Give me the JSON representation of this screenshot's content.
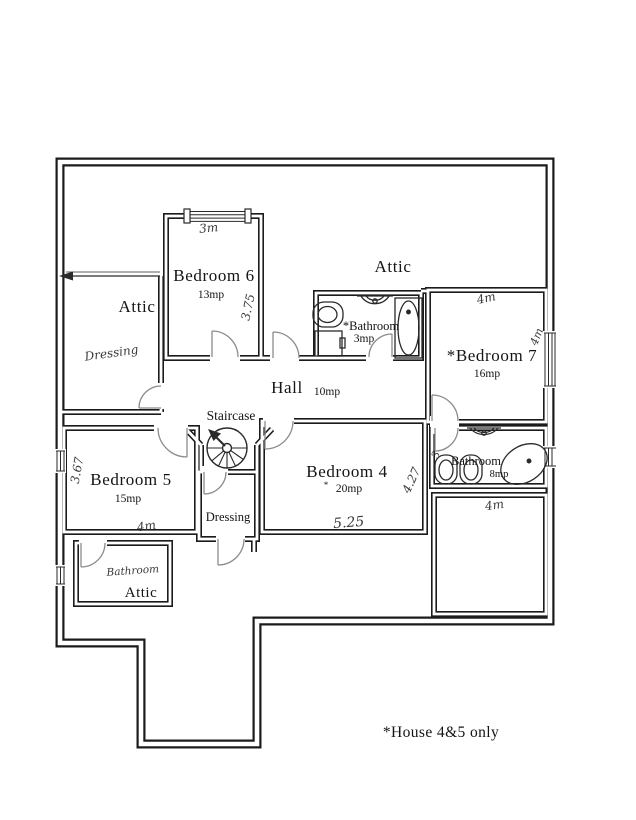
{
  "note": "*House 4&5 only",
  "rooms": {
    "attic_nw": {
      "name": "Attic",
      "annotation": "Dressing"
    },
    "bedroom6": {
      "name": "Bedroom 6",
      "area": "13mp"
    },
    "attic_top": {
      "name": "Attic"
    },
    "bathroom3": {
      "name": "*Bathroom",
      "area": "3mp"
    },
    "bedroom7": {
      "name": "*Bedroom 7",
      "area": "16mp"
    },
    "hall": {
      "name": "Hall",
      "area": "10mp"
    },
    "staircase": {
      "name": "Staircase"
    },
    "bedroom5": {
      "name": "Bedroom 5",
      "area": "15mp"
    },
    "dressing": {
      "name": "Dressing"
    },
    "bedroom4": {
      "name": "Bedroom 4",
      "area": "20mp",
      "area_mark": "*"
    },
    "bathroom8": {
      "name": "Bathroom",
      "area": "8mp"
    },
    "attic_sw": {
      "name": "Attic",
      "annotation": "Bathroom"
    }
  },
  "measurements": {
    "bedroom6_top": "3m",
    "bedroom6_side": "3.75",
    "bedroom7_top": "4m",
    "bedroom7_side": "4m",
    "bedroom5_side": "3.67",
    "bedroom5_bottom": "4m",
    "bedroom4_bottom": "5.25",
    "bedroom4_side": "4.27",
    "bathroom8_note": "3",
    "storage_top": "4m"
  },
  "colors": {
    "paper": "#ffffff",
    "wall": "#1b1b1b",
    "door_arc": "#8c8c8c",
    "fixture": "#2a2a2a"
  }
}
